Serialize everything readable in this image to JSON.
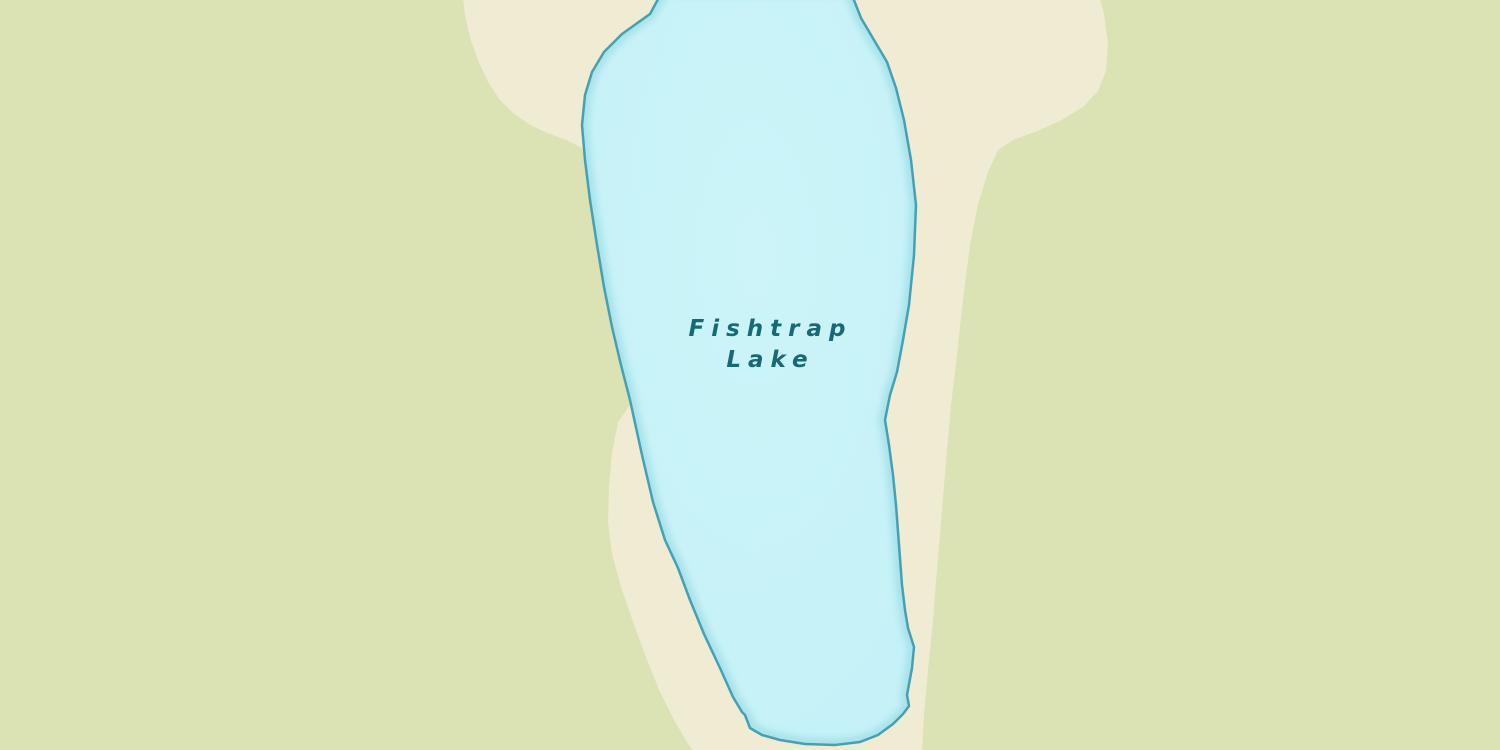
{
  "map": {
    "kind": "vector-map-view",
    "lake": {
      "label_line1": "Fishtrap",
      "label_line2": "Lake"
    }
  },
  "colors": {
    "land_green": "#dbe2b3",
    "land_cream": "#efecd3",
    "lake_fill": "#c3f1f7",
    "lake_fill_light": "#ccf4f9",
    "lake_rim": "#8fd6e0",
    "lake_outline": "#45a1b1",
    "label_text": "#156a76"
  }
}
